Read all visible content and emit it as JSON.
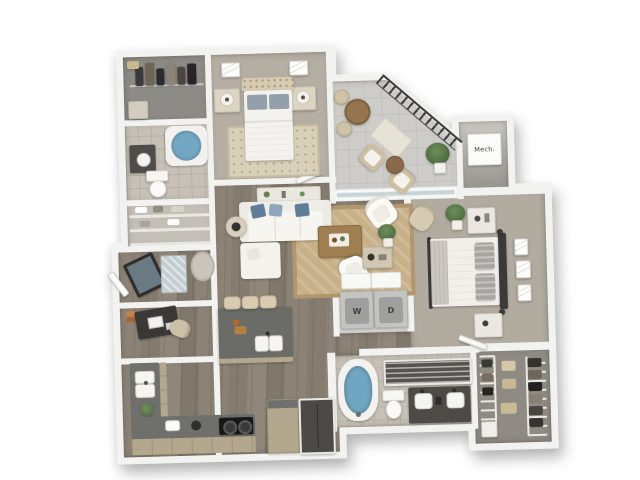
{
  "scene": {
    "type": "3D rendered apartment floor plan, top-down view",
    "background": "#ffffff"
  },
  "labels": {
    "mech": "Mech.",
    "washer": "W",
    "dryer": "D"
  },
  "palette": {
    "wall": "#f2f2f0",
    "wood_floor": "#877e71",
    "bedroom_carpet": "#b5aea3",
    "tile_floor": "#c6c0b6",
    "balcony_concrete": "#cdccc9",
    "area_rug_tan": "#c8b189",
    "sofa_white": "#f4f2ed",
    "pillow_blue": "#5f7c99",
    "bath_water_blue": "#6fa7c3",
    "island_gray": "#6b6b67",
    "counter_beige": "#b3a78e",
    "railing_dark": "#3c3c3c",
    "plant_green": "#5f7d4d",
    "wood_table": "#9f7e52"
  },
  "rooms": [
    {
      "id": "walk-in-closet-a",
      "furniture": [
        "hanging-clothes",
        "storage-boxes",
        "dresser"
      ]
    },
    {
      "id": "bedroom-2",
      "furniture": [
        "bed",
        "tufted-headboard",
        "pillows",
        "nightstands",
        "table-lamps",
        "area-rug",
        "wall-art"
      ]
    },
    {
      "id": "bathroom-2",
      "furniture": [
        "bathtub",
        "vanity-sink",
        "toilet"
      ]
    },
    {
      "id": "linen-closet",
      "furniture": [
        "shelves",
        "linens"
      ]
    },
    {
      "id": "entry",
      "furniture": [
        "front-door",
        "doormat",
        "leaning-mirror",
        "oval-rug"
      ]
    },
    {
      "id": "office-nook",
      "furniture": [
        "desk",
        "desk-chair",
        "laptop",
        "books"
      ]
    },
    {
      "id": "kitchen",
      "furniture": [
        "l-shaped-counter",
        "double-sink",
        "cooktop",
        "toaster",
        "kettle",
        "tall-cabinet",
        "refrigerator",
        "island",
        "island-sink",
        "bar-stools",
        "potted-plant"
      ]
    },
    {
      "id": "living-room",
      "furniture": [
        "sectional-sofa",
        "chaise",
        "accent-pillows",
        "sofa-console",
        "coffee-table",
        "armchair",
        "armchair-2",
        "side-table",
        "lamp",
        "console-table",
        "floor-plant",
        "area-rug"
      ]
    },
    {
      "id": "balcony",
      "furniture": [
        "railing",
        "bistro-table",
        "bistro-chairs",
        "outdoor-rug",
        "lounge-chairs",
        "outdoor-table",
        "potted-plant",
        "sliding-glass-doors"
      ]
    },
    {
      "id": "mechanical-closet",
      "furniture": [
        "mechanical-unit"
      ]
    },
    {
      "id": "laundry-closet",
      "furniture": [
        "washer",
        "dryer",
        "upper-cabinets"
      ]
    },
    {
      "id": "master-bedroom",
      "furniture": [
        "bed",
        "metal-headboard",
        "striped-pillows",
        "knit-throw",
        "nightstands",
        "potted-plant",
        "wall-art",
        "armchair",
        "closet-door"
      ]
    },
    {
      "id": "master-bathroom",
      "furniture": [
        "soaking-tub",
        "walk-in-shower",
        "toilet",
        "double-vanity"
      ]
    },
    {
      "id": "walk-in-closet-b",
      "furniture": [
        "wire-shelving",
        "hanging-clothes",
        "storage-boxes",
        "hamper"
      ]
    }
  ]
}
